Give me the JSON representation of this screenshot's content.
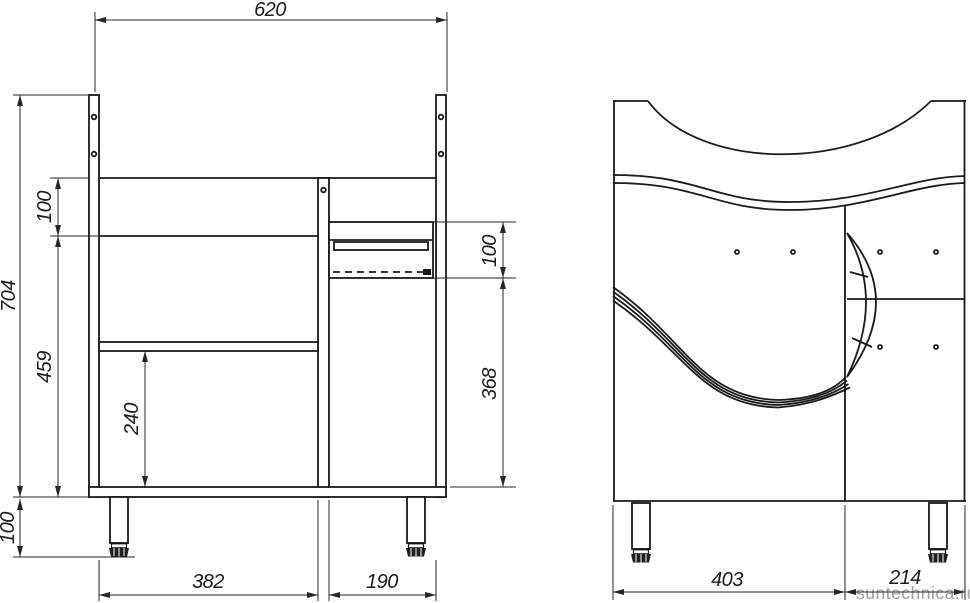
{
  "colors": {
    "ink": "#1a1a1a",
    "dimension_ink": "#262626",
    "watermark": "#9d9d9d",
    "background": "#ffffff"
  },
  "watermark": {
    "text": "suntechnica.ru"
  },
  "carcass_view": {
    "dims": {
      "overall_width": "620",
      "overall_height": "704",
      "apron_height": "100",
      "carcass_height": "459",
      "leg_height": "100",
      "shelf_clearance": "240",
      "basket_height": "100",
      "under_basket_height": "368",
      "left_bay_width": "382",
      "right_bay_width": "190"
    }
  },
  "front_view": {
    "dims": {
      "door_width": "403",
      "side_module_width": "214"
    }
  }
}
